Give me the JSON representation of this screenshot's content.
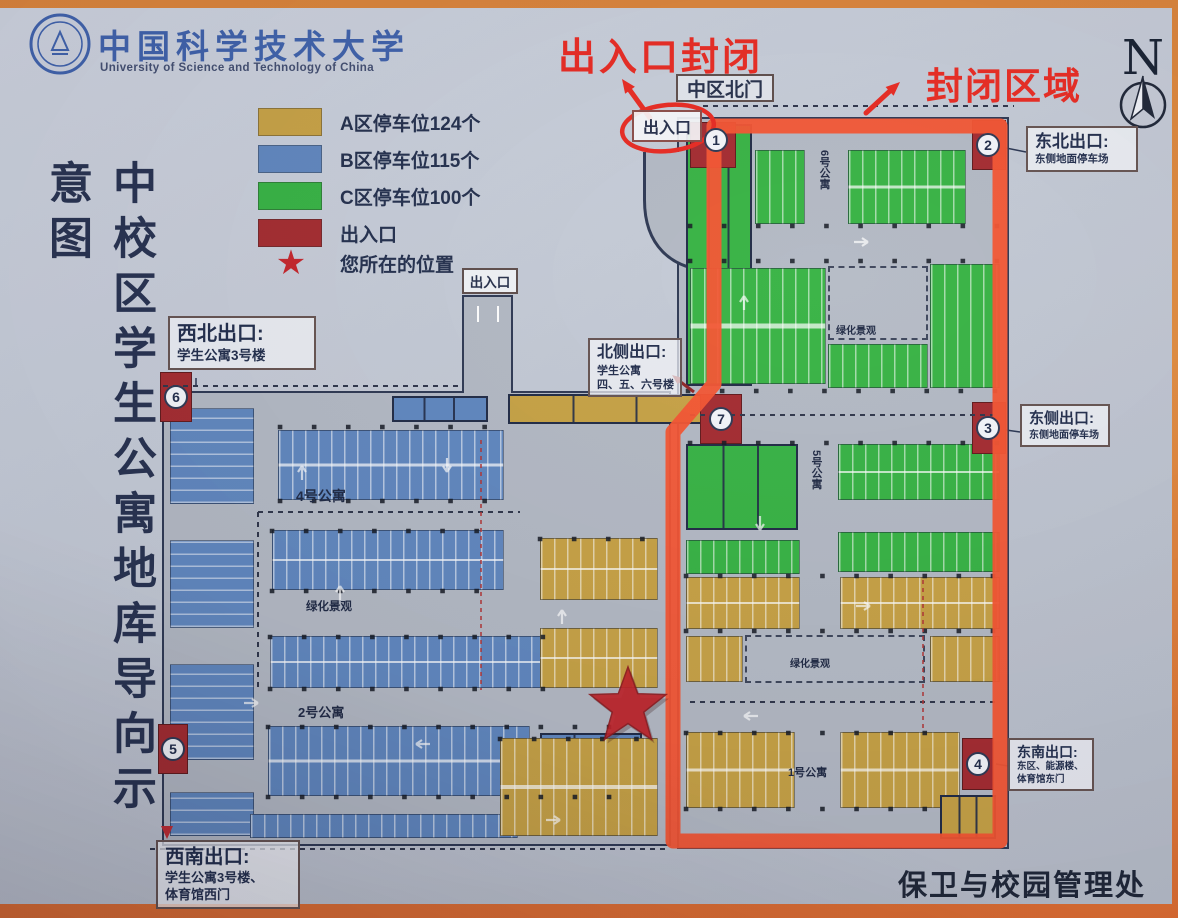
{
  "header": {
    "university_cn": "中国科学技术大学",
    "university_en": "University of Science and Technology of China"
  },
  "title": {
    "text": "中校区学生公寓地库导向示意图"
  },
  "legend": {
    "items": [
      {
        "label": "A区停车位124个",
        "color": "#c6a041"
      },
      {
        "label": "B区停车位115个",
        "color": "#5d85be"
      },
      {
        "label": "C区停车位100个",
        "color": "#33b240"
      },
      {
        "label": "出入口",
        "color": "#a3272c"
      },
      {
        "label": "您所在的位置",
        "color": "#c42127",
        "symbol": "star"
      }
    ]
  },
  "annotations": {
    "entrance_closed": "出入口封闭",
    "closed_area": "封闭区域",
    "color": "#e8261d"
  },
  "compass": {
    "label": "N"
  },
  "map": {
    "north_gate": "中区北门",
    "entrance_top": "出入口",
    "entrance_west": "出入口",
    "exits": {
      "nw": {
        "title": "西北出口:",
        "lines": [
          "学生公寓3号楼"
        ]
      },
      "n": {
        "title": "北侧出口:",
        "lines": [
          "学生公寓",
          "四、五、六号楼"
        ]
      },
      "ne": {
        "title": "东北出口:",
        "lines": [
          "东侧地面停车场"
        ]
      },
      "e": {
        "title": "东侧出口:",
        "lines": [
          "东侧地面停车场"
        ]
      },
      "se": {
        "title": "东南出口:",
        "lines": [
          "东区、能源楼、",
          "体育馆东门"
        ]
      },
      "sw": {
        "title": "西南出口:",
        "lines": [
          "学生公寓3号楼、",
          "体育馆西门"
        ]
      }
    },
    "markers": [
      "1",
      "2",
      "3",
      "4",
      "5",
      "6",
      "7"
    ],
    "labels": {
      "apt1": "1号公寓",
      "apt2": "2号公寓",
      "apt4": "4号公寓",
      "apt5": "5号公寓",
      "apt6": "6号公寓",
      "green_b": "绿化景观",
      "green_c": "绿化景观",
      "green_a": "绿化景观"
    },
    "colors": {
      "zone_a": "#c6a041",
      "zone_b": "#5d85be",
      "zone_c": "#33b240",
      "entrance": "#a3272c",
      "closed_outline": "#f5512d",
      "star": "#c01e24"
    }
  },
  "footer": {
    "department": "保卫与校园管理处"
  }
}
